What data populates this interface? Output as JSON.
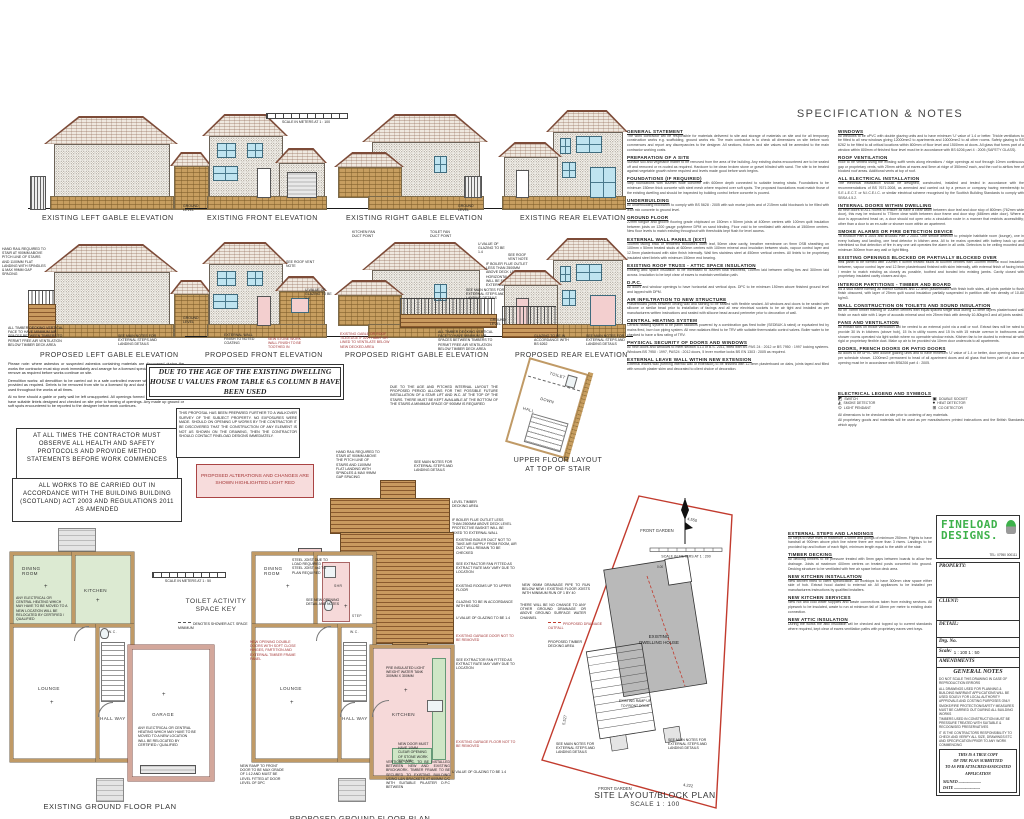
{
  "colors": {
    "site_boundary": "#c23b2e",
    "highlight_pink": "#f6d9d9",
    "deck_brown": "#b97f46",
    "stone_tan": "#c59c5e",
    "room_green": "#dcead2",
    "window_blue": "#bfe3ef",
    "logo_green": "#3db14a",
    "accent_red": "#a33636"
  },
  "titles": {
    "spec": "SPECIFICATION & NOTES",
    "e_left": "EXISTING LEFT GABLE ELEVATION",
    "e_front": "EXISTING FRONT ELEVATION",
    "e_right": "EXISTING RIGHT GABLE ELEVATION",
    "e_rear": "EXISTING REAR ELEVATION",
    "p_left": "PROPOSED LEFT GABLE ELEVATION",
    "p_front": "PROPOSED FRONT ELEVATION",
    "p_right": "PROPOSED RIGHT GABLE ELEVATION",
    "p_rear": "PROPOSED REAR ELEVATION",
    "e_plan": "EXISTING GROUND FLOOR PLAN",
    "p_plan": "PROPOSED GROUND FLOOR PLAN",
    "site": "SITE LAYOUT/BLOCK PLAN",
    "site_scale": "SCALE 1 : 100",
    "upper1": "UPPER FLOOR LAYOUT",
    "upper2": "AT TOP OF STAIR"
  },
  "scalebars": {
    "m100": "SCALE IN METERS AT 1 : 100",
    "m50": "SCALE IN METERS AT 1 : 50",
    "m200": "SCALE IN METERS AT 1 : 200"
  },
  "rooms": {
    "dining1": "DINING",
    "dining2": "ROOM",
    "kitchen": "KITCHEN",
    "lounge": "LOUNGE",
    "hall1": "HALL",
    "hall2": "WAY",
    "garage": "GARAGE",
    "wc": "W.C.",
    "shr": "SHR",
    "toilet": "TOILET",
    "down": "DOWN",
    "step": "STEP"
  },
  "keys": {
    "toilet_key1": "TOILET ACTIVITY",
    "toilet_key2": "SPACE KEY",
    "toilet_leg": "DENOTES SHOWER ACT. SPACE MINIMUM"
  },
  "boxes": {
    "uvalues": "DUE TO THE AGE OF THE EXISTING DWELLING HOUSE U VALUES FROM TABLE 6.5 COLUMN B HAVE BEEN USED",
    "contractor": "AT ALL TIMES THE CONTRACTOR MUST OBSERVE ALL HEALTH AND SAFETY PROTOCOLS AND PROVIDE METHOD STATEMENTS BEFORE WORK COMMENCES",
    "works": "ALL WORKS TO BE CARRIED OUT IN ACCORDANCE WITH THE BUILDING BUILDING (SCOTLAND) ACT 2003 AND REGULATIONS 2011 AS AMENDED",
    "survey": "THIS PROPOSAL HAS BEEN PREPARED FURTHER TO A WALKOVER SURVEY OF THE SUBJECT PROPERTY. NO EXPOSURES WERE MADE. SHOULD ON OPENING UP WORKS BY THE CONTRACTOR IT BE DISCOVERED THAT THE CONSTRUCTION OF ANY ELEMENT IS NOT AS SHOWN ON THE DRAWING, THEN THE CONTRACTOR SHOULD CONTACT FINELOAD DESIGNS IMMEDIATELY.",
    "pink": "PROPOSED ALTERATIONS AND CHANGES ARE SHOWN HIGHLIGHTED LIGHT RED",
    "para1": "Please note: where asbestos or suspected asbestos containing materials are discovered during the works the contractor must stop work immediately and arrange for a licensed specialist to survey, test and remove as required before works continue on site.",
    "para2": "Demolition works: all demolition to be carried out in a safe controlled manner with temporary propping provided as required. Debris to be removed from site to a licensed tip and dust suppression measures used throughout the works at all times.",
    "para3": "At no time should a gable or party wall be left unsupported. All openings formed in loadbearing walls to have suitable lintels designed and checked on site prior to forming of openings. Any made up ground or soft spots encountered to be reported to the designer before work continues."
  },
  "ann": {
    "gl": "GROUND LEVEL",
    "upper_note": "DUE TO THE AGE AND PITCHED INTERNAL LAYOUT THE PROPOSED PERIOD ALLOWS FOR THE POSSIBLE FUTURE INSTALLATION OF A STAIR LIFT AND W.C. AT THE TOP OF THE STAIRS. THERE MUST BE KEPT AVAILABLE AT THE BOTTOM OF THE STAIRS A MINIMUM SPACE OF 900MM IS REQUIRED",
    "pl": [
      "HAND RAIL REQUIRED TO STAIR AT 900MM ABOVE PITCH LINE OF STAIRS AND 1100MM FLAT LANDING WITH SPINDLES & MAX 99MM GAP SPACING",
      "ALL TIMBER DECKING VERTICAL FACE TO HAVE MINIMUM AIR SPACES BETWEEN TIMBERS TO PERMIT FREE AIR VENTILATION BELOW TIMBER DECK AREA",
      "SEE MAIN NOTES FOR EXTERNAL STEPS AND LANDING DETAILS"
    ],
    "pf": [
      "SEE ROOF VENT NOTE",
      "U VALUE OF GLAZING TO BE 1.4",
      "EXTERNAL WALL FINISH TO NOTED COATING",
      "NEW STONE WORK WALL FINISH TO BE TOOTHED IN"
    ],
    "pr": [
      "KITCHEN FAN DUCT POINT",
      "TOILET FAN DUCT POINT",
      "U VALUE OF GLAZING TO BE 1.4",
      "IF BOILER FLUE OUTLET LESS THAN 2500MM ABOVE DECK LEVEL HORIZONTAL EXHAUST WILL BE FIXED TO EXTERNAL WALL",
      "SEE MAIN NOTES FOR EXTERNAL STEPS AND LANDING DETAILS",
      "ALL TIMBER DECKING VERTICAL FACE TO HAVE MINIMUM AIR SPACES BETWEEN TIMBERS TO PERMIT FREE AIR VENTILATION BELOW TIMBER DECK AREA",
      "EXISTING GABLE OR ROOF TILE/EDGE IF ANY HABIT OR LINED TO VENTILATE BELOW NEW DECKED AREA"
    ],
    "pb": [
      "SEE ROOF VENT NOTE",
      "GLAZING TO BE IN ACCORDANCE WITH BS 6262",
      "SEE MAIN NOTES FOR EXTERNAL STEPS AND LANDING DETAILS"
    ],
    "deck": [
      "HAND RAIL REQUIRED TO STAIR AT 900MM ABOVE THE PITCH LINE OF STAIRS AND 1100MM FLAT LANDING WITH SPINDLES & MAX 99MM GAP SPACING",
      "SEE MAIN NOTES FOR EXTERNAL STEPS AND LANDING DETAILS",
      "LEVEL TIMBER DECKING AREA",
      "IF BOILER FLUE OUTLET LESS THAN 2500MM ABOVE DECK LEVEL PROTECTIVE BASKET WILL BE FIXED TO EXTERNAL WALL"
    ],
    "ep_note": "ANY ELECTRICAL OR CENTRAL HEATING WHICH MAY HAVE TO BE MOVED TO A NEW LOCATION WILL BE RELOCATED BY CERTIFIED / QUALIFIED",
    "pp_left": [
      "STEEL JOIST DUE TO LOAD REQUIRED STEEL JOIST 4x2 TO PLAN REQUIRED",
      "SEE NEW OPENING DETAIL AND NOTES",
      "NEW OPENING DOUBLE DOORS WITH SOFT CLOSE HINGES, PARTITION AND EXTERNAL TIMBER FRAME PANEL",
      "PRE INSULATED LIGHT WEIGHT WATER TANK 300MM X 300MM",
      "NEW DOOR MUST HAVE 10MM CLEAR OPENING OF STONE WORK 30% MIN",
      "NEW RAMP TO FRONT DOOR TO BE MAX GRADE OF 1:12 AND MUST BE LEVEL FITTED AT DOOR LEVEL OF DPC",
      "VERTICAL D.P.C. TO BE INSTALLED BETWEEN NEW AND EXISTING BRICKWORK. TIMBER FRAME TO BE SECURED TO EXISTING BUILDING USING L&N BRACKETS AT 600MM C/C WITH SUITABLE PILASTER D.P.C BETWEEN",
      "NEW 50MM SHOWER DRAINAGE PIPE TO RUN BELOW FLOOR"
    ],
    "pp_right": [
      "EXISTING BOILER DUCT NOT TO TAKE AIR SUPPLY FROM ROOM, AIR DUCT WILL REMAIN TO BE CHECKED",
      "SEE EXTRACTOR FAN FITTED AS EXTRACT RATE MAY VARY DUE TO LOCATION",
      "EXISTING ROOMS UP TO UPPER FLOOR",
      "GLAZING TO BE IN ACCORDANCE WITH BS 6262",
      "U VALUE OF GLAZING TO BE 1.4",
      "EXISTING GARAGE DOOR NOT TO BE REMOVED",
      "SEE EXTRACTOR FAN FITTED AS EXTRACT RATE MAY VARY DUE TO LOCATION",
      "EXISTING GARAGE FLOOR NOT TO BE REMOVED",
      "U VALUE OF GLAZING TO BE 1.4"
    ],
    "site": [
      "NEW 90MM DRAINAGE PIPE TO RUN BELOW NEW / EXISTING FLOOR JOISTS WITH MINIMUM RUN OF 1 BY 40",
      "THERE WILL BE NO CHANGE TO ANY OTHER GROUND DRAINAGE OR ABOVE GROUND SURFACE WATER CHANNEL",
      "PROPOSED DRAINAGE OUTFALL",
      "PROPOSED TIMBER DECKING AREA",
      "SEE MAIN NOTES FOR EXTERNAL STEPS AND LANDING DETAILS",
      "SEE MAIN NOTES FOR EXTERNAL STEPS AND LANDING DETAILS"
    ],
    "site_svg": {
      "front_garden_top": "FRONT GARDEN",
      "front_garden_bottom": "FRONT GARDEN",
      "dwelling1": "EXISTING",
      "dwelling2": "DWELLING HOUSE",
      "ramp1": "EXISTING RAMP UP",
      "ramp2": "TO FRONT DOOR",
      "d1": "4.550",
      "d2": "5.527",
      "d3": "4.222",
      "d4": "0.00"
    }
  },
  "spec": {
    "col1": [
      {
        "h": "GENERAL STATEMENT",
        "b": "The work contractor will be responsible for materials delivered to site and storage of materials on site and for all temporary construction works e.g. scaffolding, ground works etc. The main contractor is to check all dimensions on site before work commences and report any discrepancies to the designer. All sections, fixtures and site values will be amended to the main contractor working costs."
      },
      {
        "h": "PREPARATION OF A SITE",
        "b": "Surface soil and vegetable matter to be removed from the area of the building. Any existing drains encountered are to be sealed off and removed or re-routed as required. Hardcore to be clean broken stone or gravel blinded with sand. The site to be treated against vegetable growth where required and levels made good before work begins."
      },
      {
        "h": "FOUNDATIONS (IF REQUIRED)",
        "b": "Strip foundations with 600mm wide concrete with 600mm depth connected to suitable bearing strata. Foundations to be minimum 150mm thick concrete with steel mesh where required over soft spots. The proposed foundations must match those of the existing dwelling and should be inspected by building control before concrete is poured."
      },
      {
        "h": "UNDERBUILDING",
        "b": "All underbuilding blockwork to comply with BS 5628 : 2005 with sub mortar joints and of 215mm solid blockwork to be filled with lean mix concrete to ground level."
      },
      {
        "h": "GROUND FLOOR",
        "b": "22mm tongue and groove flooring grade chipboard on 150mm x 50mm joists at 400mm centres with 100mm quilt insulation between joists on 1200 gauge polythene DPM on sand blinding. Floor void to be ventilated with airbricks at 1500mm centres. New floor levels to match existing throughout with thresholds kept flush for level access."
      },
      {
        "h": "EXTERNAL WALL PANELS (EXT)",
        "b": "100mm facing brick or rendered blockwork outer leaf, 50mm clear cavity, breather membrane on 9mm OSB sheathing on 100mm x 50mm treated studs at 600mm centres with 100mm mineral wool insulation between studs, vapour control layer and 12.5mm plasterboard with skim finish internally. Wall ties stainless steel at 450mm vertical centres. All lintels to be proprietary insulated steel lintels with minimum 150mm end bearing."
      },
      {
        "h": "EXISTING ROOF TRUSS - ATTIC SPACE INSULATION",
        "b": "Existing attic space insulation to be increased to 400mm total thickness, 100mm laid between ceiling ties and 300mm laid across. Insulation to be kept clear of eaves to maintain ventilation path."
      },
      {
        "h": "D.P.C.",
        "b": "All doors and window openings to have horizontal and vertical dpcs. DPC to be minimum 150mm above finished ground level and lapped with DPM."
      },
      {
        "h": "AIR INFILTRATION TO NEW STRUCTURE",
        "b": "Plasterboard joints between ceiling wall and skirting to be sealed with flexible sealant. All windows and doors to be sealed with silicone or similar bead prior to installation of facings and all new electrical sockets to be air tight and installed as per manufacturers written instructions and sealed with silicone bead around perimeter prior to decoration of wall."
      },
      {
        "h": "CENTRAL HEATING SYSTEM",
        "b": "Central heating system to be panel radiators powered by a combination gas fired boiler (SEDBUK A rated) or equivalent fed by mains fired, burn low piping system. All new radiators fitted to be TRV with suitable thermostatic control valves. Boiler water to be checked to have a flow rating of TRV."
      },
      {
        "h": "PHYSICAL SECURITY OF DOORS AND WINDOWS",
        "b": "All new doors and windows to meet section 4.13 of B.S. 2011, fitted with BS PAS 24 : 2012 or BS 7950 : 1997 locking systems. Windows BS 7950 : 1997, PAS24 : 2012 doors, 5 lever mortice locks BS EN 1303 : 2005 as required."
      },
      {
        "h": "EXTERNAL LEAVE WALL WITHIN NEW EXTENSION",
        "b": "External leaves wall (forming internal wall of extension) to be finished with 12.5mm plasterboard on dabs, joints taped and filled with smooth plaster skim and decorated to client choice of decoration."
      }
    ],
    "col2": [
      {
        "h": "WINDOWS",
        "b": "All windows to be uPVC with double glazing units and to have minimum 'U' value of 1.4 or better. Trickle ventilators to be fitted to all new windows giving 12000mm2 to apartments and 10000mm2 to all other rooms. Safety glazing to BS 6262 to be fitted to all critical locations within 800mm of floor level and 1500mm at doors. All glass that forms part of a window within 800mm of finished floor level must be in accordance with BS 6206 part 4 : 2005 (SAFETY GLASS)."
      },
      {
        "h": "ROOF VENTILATION",
        "b": "Roof to be vented using the existing soffit vents along elevations / ridge openings at roof through 10mm continuous gap or proprietary vents, with 25mm airflow at eaves and 5mm at ridge of 350mm2 each, and the roof to airflow free of blocked roof areas. Additional vents at top of roof."
      },
      {
        "h": "ALL ELECTRICAL INSTALLATION",
        "b": "The electrical installation should be designed, constructed, installed and tested in accordance with the recommendations of BS 7671:2008, as amended and carried out by a person or company having membership to S.E.L.E.C.T. or N.I.C.E.I.C. or similar electrical scheme recognised by the Scottish Building Standards to comply with SBSA 4.5.2."
      },
      {
        "h": "INTERNAL DOORS WITHIN DWELLING",
        "b": "All new doors to ALL rooms to ensure all have a clear width between door leaf and door stop of 800mm (762mm wide door), this may be reduced to 775mm clear width between door frame and door stop (686mm wide door). Where a door is approached head on, a door should not open onto a circulation route in a manner that restricts accessibility; other than a door to an en-suite or shower room within an apartment."
      },
      {
        "h": "SMOKE ALARMS OR FIRE DETECTION DEVICE",
        "b": "To BS5839 Part 6 2004 and BS5446 Part 2 2003. One smoke detector to principle habitable room (lounge), one in every hallway and landing, one heat detector in kitchen area. All to be mains operated with battery back up and interlinked so that detection of fire in any one unit operates the alarm in all units. Detectors to be ceiling mounted and minimum 300mm from any wall or light fitting."
      },
      {
        "h": "EXISTING OPENINGS BLOCKED OR PARTIALLY BLOCKED OVER",
        "b": "Infill panel to be formed with 100mm x 50mm treated studs at 600mm centres with 100mm mineral wool insulation between, vapour control layer and 12.5mm plasterboard finished with skim internally, with external finish of facing brick / render to match existing as closely as possible, toothed and bonded into existing jambs. Cavity closed with proprietary insulated cavity closers and dpc."
      },
      {
        "h": "INTERIOR PARTITIONS - TIMBER AND BOARD",
        "b": "As a stud frame forming all interior surfaces and 12.5mm plasterboard with finish both sides, all joints particle to flush finish obscured, with layer of 25mm quilt sound insulation partially suspended in partition with min density of 10-80 kg/m3."
      },
      {
        "h": "WALL CONSTRUCTION ON TOILETS AND SOUND INSULATION",
        "b": "All on 75mm timber framing or 100mm centres with equal spaced single stud during 12.5mm layers plasterboard wall finish on each side with 1 layer of acoustic mineral wool min 25mm thick with density 10-80kg/m3 and all joints sealed."
      },
      {
        "h": "FANS AND VENTILATION",
        "b": "All extract fans on trickle ventilation will be vented to an external point via a wall or roof. Extract fans will be rated to provide 30 l/s in kitchens (above hob), 15 l/s in utility rooms and 15 l/s with 15 minute overrun in bathrooms and shower rooms operated via light switch where no openable window exists. Kitchen fan to be ducted to external air with rigid or proprietary flexible duct. Make up air to be provided via 10mm door undercuts to all apartments."
      },
      {
        "h": "DOORS, FRENCH DOORS OR PATIO DOORS",
        "b": "All doors to be uPVC with double glazing units and to have minimum 'U' value of 1.4 or better, door opening sizes as per schedule shown. 1200mm2 permanent to head of all apartment doors and all glass that forms part of a door or opening must be in accordance with BS6206 part 4 : 2005."
      }
    ],
    "legend_title": "ELECTRICAL LEGEND AND SYMBOLS",
    "legend": [
      {
        "s": "◩",
        "l": "SWITCH"
      },
      {
        "s": "▣",
        "l": "DOUBLE SOCKET"
      },
      {
        "s": "◭",
        "l": "SMOKE DETECTOR"
      },
      {
        "s": "●",
        "l": "HEAT DETECTOR"
      },
      {
        "s": "⊙",
        "l": "LIGHT PENDANT"
      },
      {
        "s": "⊞",
        "l": "CO DETECTOR"
      }
    ],
    "col3": [
      {
        "h": "EXTERNAL STEPS AND LANDINGS",
        "b": "All steps to have rises of maximum 170mm and goings of minimum 250mm. Flights to have handrail at 900mm above pitch line where there are more than 3 risers. Landings to be provided top and bottom of each flight, minimum length equal to the width of the stair."
      },
      {
        "h": "TIMBER DECKING",
        "b": "All decking timbers to be pressure treated with 5mm gaps between boards to allow free drainage. Joists at maximum 400mm centres on treated posts concreted into ground. Decking structure to be ventilated with free air space below deck area."
      },
      {
        "h": "NEW KITCHEN INSTALLATION",
        "b": "New kitchen fitted to client specification. All worktops to have 300mm clear space either side of hob. Extract hood ducted to external air. All appliances to be installed per manufacturers instructions by qualified installers."
      },
      {
        "h": "NEW KITCHEN SERVICES",
        "b": "New hot and cold water supplies and waste connections taken from existing services. All pipework to be insulated, waste to run at minimum fall of 18mm per metre to existing drain connection."
      },
      {
        "h": "NEW ATTIC INSULATION",
        "b": "During the works the attic insulation will be checked and topped up to current standards where required, kept clear of eaves ventilation paths with proprietary eaves vent trays."
      }
    ],
    "closing1": "All dimensions to be checked on site prior to ordering of any materials.",
    "closing2": "All proprietary goods and materials will be used as per manufacturers printed instructions and the British Standards which apply."
  },
  "titleblock": {
    "brand1": "FINELOAD",
    "brand2": "DESIGNS.",
    "tel": "TEL: 07950 000111",
    "property": "PROPERTY:",
    "client": "CLIENT:",
    "detail": "DETAIL:",
    "drg": "Drg. No.",
    "scale_label": "Scale:",
    "scale_value": "1 : 100   1 : 50",
    "amendments": "AMENDMENTS",
    "gn_title": "GENERAL NOTES",
    "general_notes": [
      {
        "t": "DO NOT SCALE THIS DRAWING IN CASE OF REPRODUCTION ERRORS"
      },
      {
        "t": "ALL DRAWINGS USED FOR PLANNING & BUILDING WARRANT APPLICATIONS WILL BE USED SOLELY FOR LOCAL AUTHORITY APPROVALS AND COSTING PURPOSES ONLY"
      },
      {
        "t": "SMOKE/FIRE PROTECTION/SAFETY MEASURES MUST BE CARRIED OUT DURING ALL BUILDING WORKS"
      },
      {
        "t": "TIMBERS USED IN CONSTRUCTION MUST BE PRESSURE TREATED WITH SUITABLE & RECOGNISED PRESERVATIVES"
      },
      {
        "t": "IT IS THE CONTRACTORS RESPONSIBILITY TO CHECK AND VERIFY ALL SIZE, DRAWINGS ETC AND SPECIFICATION PRIOR TO ANY WORK COMMENCING"
      }
    ],
    "stamp": [
      {
        "t": "THIS IS A TRUE COPY"
      },
      {
        "t": "OF THE PLAN SUBMITTED"
      },
      {
        "t": "TO AS PER ATTACHED/ASSOCIATED"
      },
      {
        "t": "APPLICATION"
      }
    ],
    "signed": "SIGNED .......................",
    "date": "DATE ..........................."
  }
}
